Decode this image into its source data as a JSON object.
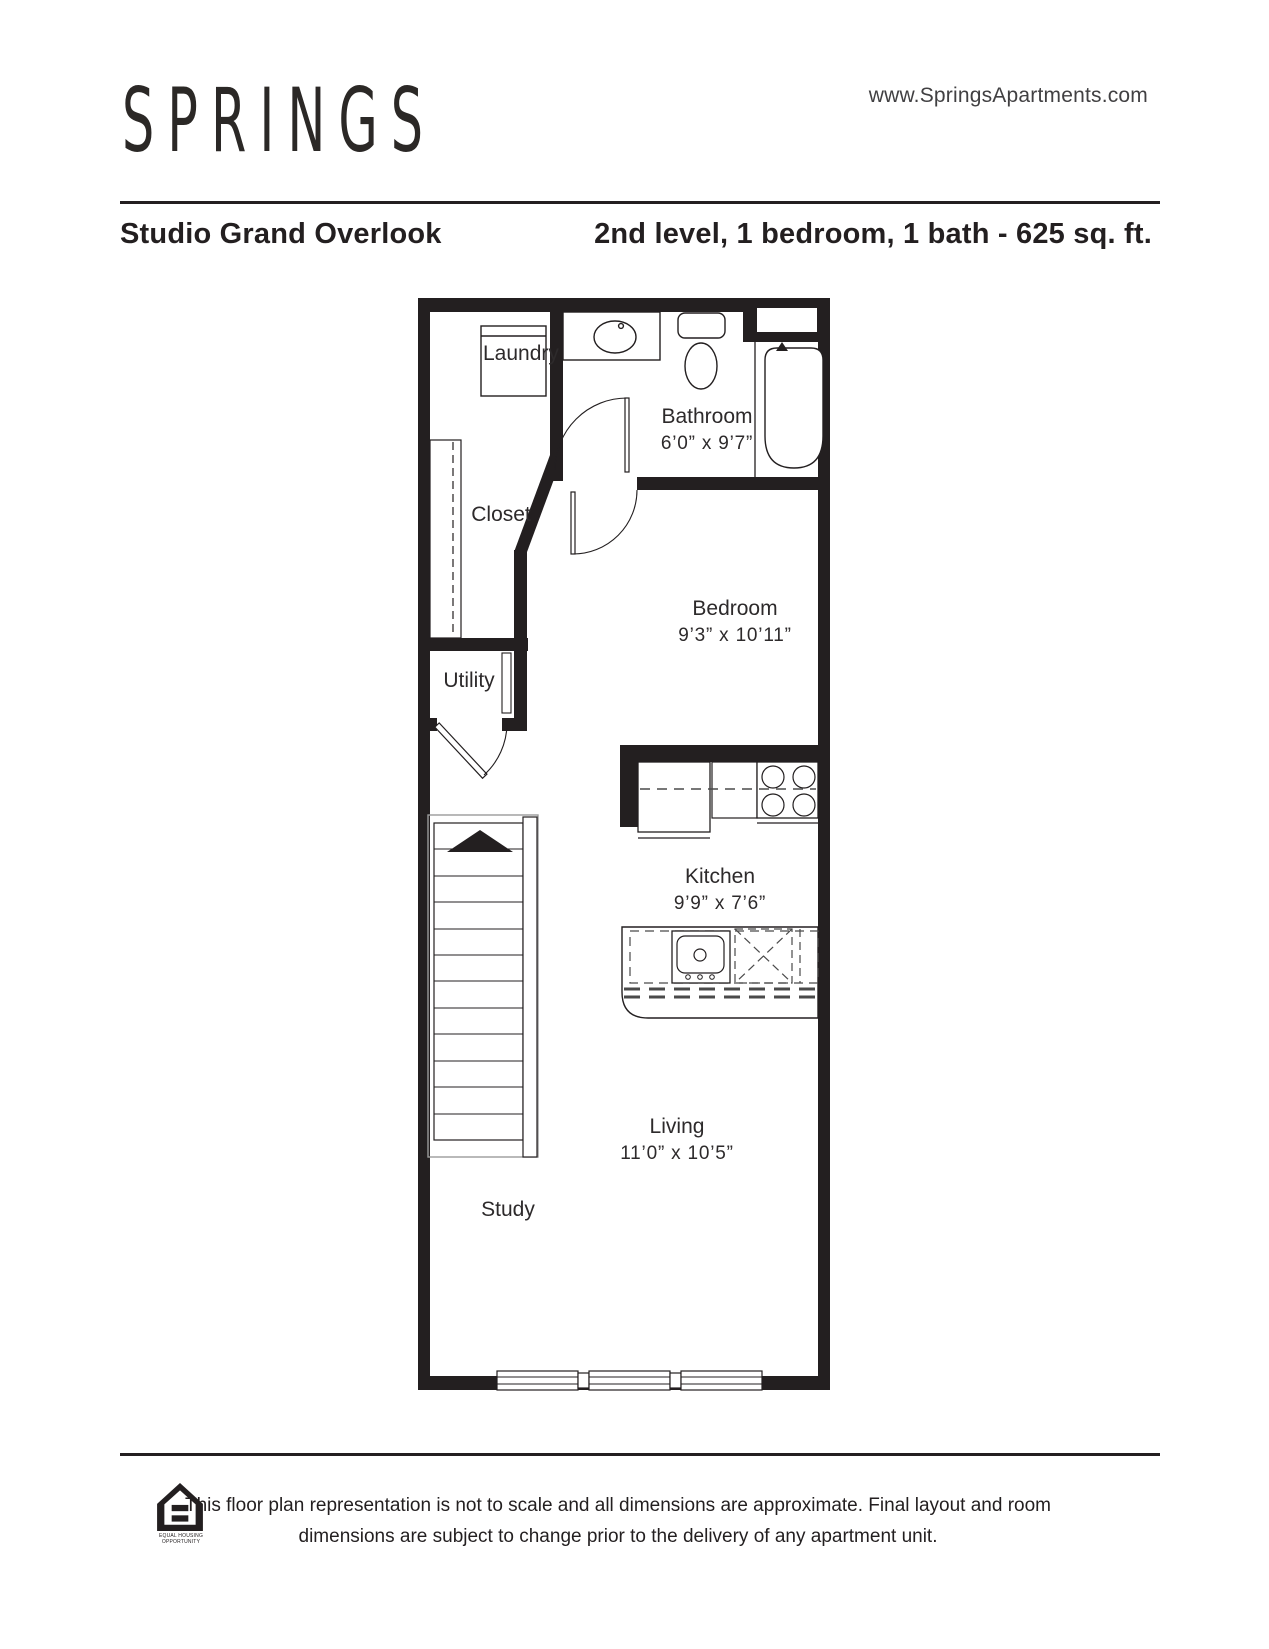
{
  "header": {
    "logo": "SPRINGS",
    "website": "www.SpringsApartments.com",
    "plan_name": "Studio Grand Overlook",
    "plan_details": "2nd level, 1 bedroom, 1 bath - 625 sq. ft."
  },
  "floorplan": {
    "rooms": [
      {
        "id": "laundry",
        "label": "Laundry",
        "dims": ""
      },
      {
        "id": "closet",
        "label": "Closet",
        "dims": ""
      },
      {
        "id": "bathroom",
        "label": "Bathroom",
        "dims": "6’0” x 9’7”"
      },
      {
        "id": "bedroom",
        "label": "Bedroom",
        "dims": "9’3” x 10’11”"
      },
      {
        "id": "utility",
        "label": "Utility",
        "dims": ""
      },
      {
        "id": "kitchen",
        "label": "Kitchen",
        "dims": "9’9” x 7’6”"
      },
      {
        "id": "living",
        "label": "Living",
        "dims": "11’0” x 10’5”"
      },
      {
        "id": "study",
        "label": "Study",
        "dims": ""
      }
    ]
  },
  "footer": {
    "eho_label": "Equal Housing Opportunity",
    "disclaimer_line1": "This floor plan representation is not to scale and all dimensions are approximate. Final layout and room",
    "disclaimer_line2": "dimensions are subject to change prior to the delivery of any apartment unit."
  },
  "colors": {
    "ink": "#231f20",
    "gray_dash": "#4a4a4a",
    "stair_outline": "#9b9b9b"
  }
}
